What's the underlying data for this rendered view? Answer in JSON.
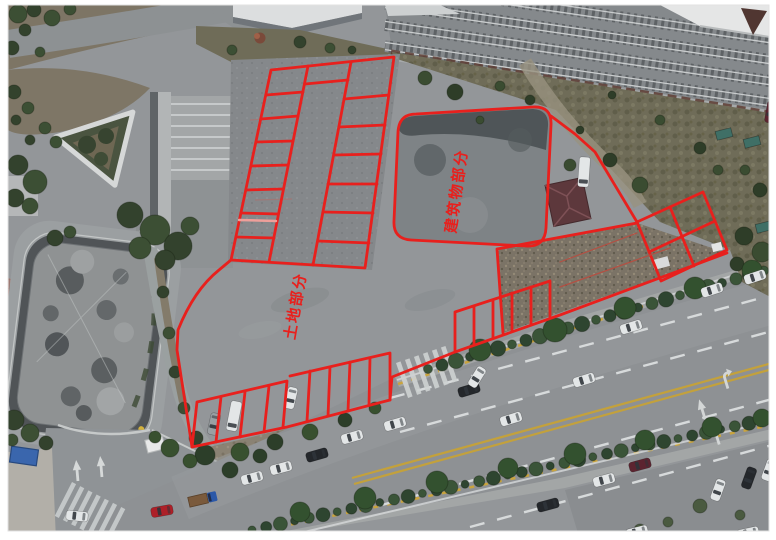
{
  "scene": {
    "background": "#ffffff",
    "asphalt": "#939699",
    "road": "#8e9194",
    "rail_ballast": "#85898c",
    "grass": "#6f6c58",
    "gravel": "#7b7366",
    "pond_rim": "#505457",
    "building_pad": "#7e8386",
    "marking_white": "#d7dadb",
    "marking_yellow": "#c3a13c",
    "hedge_green": "#2f4630",
    "shed_roof": "#5d383c"
  },
  "annotation": {
    "color": "#e8201d",
    "labels": [
      {
        "id": "building-area-label",
        "text": "建筑物部分",
        "x": 457,
        "y": 191,
        "rotate": -82,
        "size": 15
      },
      {
        "id": "land-area-label",
        "text": "土地部分",
        "x": 296,
        "y": 306,
        "rotate": -80,
        "size": 15
      }
    ],
    "paths": [
      {
        "id": "upper-grid-outline",
        "d": "M271,70 L394,57 L365,268 L231,260 Z"
      },
      {
        "id": "upper-grid-column-line-1",
        "d": "M308,66 L269,262"
      },
      {
        "id": "upper-grid-column-line-2",
        "d": "M351,62 L313,265"
      },
      {
        "id": "upper-grid-left-dividers",
        "d": "M266,95 L303,92 M261,119 L298,116 M256,142 L293,141 M251,166 L288,165 M246,190 L283,189 M241,213 L278,214 M236,237 L274,238"
      },
      {
        "id": "upper-grid-right-dividers",
        "d": "M344,99 L389,95 M339,127 L385,125 M334,155 L381,154 M328,184 L377,184 M323,212 L373,213 M318,241 L369,243"
      },
      {
        "id": "upper-grid-aisle-line",
        "d": "M305,84 L348,80"
      },
      {
        "id": "building-outline",
        "d": "M416,114 L533,107 Q552,106 551,125 L546,228 Q545,247 526,246 L411,240 Q393,239 394,221 L398,132 Q399,114 416,114 Z"
      },
      {
        "id": "northeast-boundary",
        "d": "M551,116 L575,134 L595,152 L637,222"
      },
      {
        "id": "east-grid-outline",
        "d": "M637,222 L703,192 L727,250 L661,281 Z"
      },
      {
        "id": "east-grid-inner-lines",
        "d": "M670,207 L694,266 M649,252 L715,221"
      },
      {
        "id": "gravel-area-edges",
        "d": "M497,249 L637,223 M497,249 L503,333"
      },
      {
        "id": "parcel-boundary",
        "d": "M231,260 L219,270 Q194,290 178,330 L177,350 L192,447 L287,427 L390,400 L392,377 L455,352 L560,315 L727,253"
      },
      {
        "id": "south-stalls-left",
        "d": "M197,402 L287,381 M197,402 L192,447 M221,397 L216,442 M245,392 L240,437 M269,386 L264,432 M287,381 L283,427"
      },
      {
        "id": "south-stalls-middle",
        "d": "M290,376 L390,353 L390,400 M310,371 L307,421 M330,367 L328,416 M350,362 L348,411 M370,358 L369,405"
      },
      {
        "id": "south-stalls-right",
        "d": "M455,312 L550,281 L550,318 M455,312 L455,352 M474,306 L474,345 M493,300 L493,338 M512,293 L512,331 M531,287 L531,325"
      },
      {
        "id": "faded-stall-line",
        "d": "M239,220 L276,221",
        "color": "#ef9f9a",
        "width": 2.5
      },
      {
        "id": "gravel-survey-lines",
        "d": "M560,262 L637,233 M560,287 L670,248",
        "color": "#b35043",
        "width": 1.2
      }
    ]
  },
  "vehicle_colors": {
    "white": "#e3e6e7",
    "dark": "#24272b",
    "red": "#ad2028",
    "maroon": "#5c2430",
    "silver": "#9aa0a3",
    "blue": "#2b58a8",
    "teal": "#3f6f66"
  },
  "vehicles": [
    {
      "x": 584,
      "y": 380,
      "r": -17,
      "t": "car",
      "c": "white"
    },
    {
      "x": 631,
      "y": 327,
      "r": -17,
      "t": "car",
      "c": "white"
    },
    {
      "x": 712,
      "y": 290,
      "r": -18,
      "t": "car",
      "c": "white"
    },
    {
      "x": 755,
      "y": 277,
      "r": -18,
      "t": "car",
      "c": "white"
    },
    {
      "x": 469,
      "y": 390,
      "r": -17,
      "t": "car",
      "c": "dark"
    },
    {
      "x": 511,
      "y": 419,
      "r": -17,
      "t": "car",
      "c": "white"
    },
    {
      "x": 162,
      "y": 511,
      "r": -10,
      "t": "car",
      "c": "red"
    },
    {
      "x": 203,
      "y": 499,
      "r": -13,
      "t": "truck",
      "c": "blue"
    },
    {
      "x": 252,
      "y": 478,
      "r": -15,
      "t": "car",
      "c": "white"
    },
    {
      "x": 281,
      "y": 468,
      "r": -15,
      "t": "car",
      "c": "white"
    },
    {
      "x": 317,
      "y": 455,
      "r": -16,
      "t": "car",
      "c": "dark"
    },
    {
      "x": 352,
      "y": 437,
      "r": -16,
      "t": "car",
      "c": "white"
    },
    {
      "x": 395,
      "y": 424,
      "r": -16,
      "t": "car",
      "c": "white"
    },
    {
      "x": 548,
      "y": 505,
      "r": -15,
      "t": "car",
      "c": "dark"
    },
    {
      "x": 604,
      "y": 480,
      "r": -15,
      "t": "car",
      "c": "white"
    },
    {
      "x": 640,
      "y": 465,
      "r": -15,
      "t": "car",
      "c": "maroon"
    },
    {
      "x": 718,
      "y": 490,
      "r": -70,
      "t": "car",
      "c": "white"
    },
    {
      "x": 749,
      "y": 478,
      "r": -70,
      "t": "car",
      "c": "dark"
    },
    {
      "x": 769,
      "y": 470,
      "r": -70,
      "t": "car",
      "c": "white"
    },
    {
      "x": 748,
      "y": 533,
      "r": -12,
      "t": "car",
      "c": "white"
    },
    {
      "x": 637,
      "y": 532,
      "r": -14,
      "t": "car",
      "c": "white"
    },
    {
      "x": 214,
      "y": 424,
      "r": -78,
      "t": "car",
      "c": "silver"
    },
    {
      "x": 234,
      "y": 416,
      "r": -79,
      "t": "van",
      "c": "white"
    },
    {
      "x": 291,
      "y": 398,
      "r": -77,
      "t": "car",
      "c": "white"
    },
    {
      "x": 477,
      "y": 377,
      "r": -58,
      "t": "car",
      "c": "white"
    },
    {
      "x": 77,
      "y": 516,
      "r": 6,
      "t": "car",
      "c": "white"
    },
    {
      "x": 584,
      "y": 172,
      "r": -86,
      "t": "van",
      "c": "white"
    },
    {
      "x": 771,
      "y": 112,
      "r": -80,
      "t": "car",
      "c": "maroon"
    },
    {
      "x": 724,
      "y": 134,
      "r": -14,
      "t": "box",
      "c": "teal"
    },
    {
      "x": 752,
      "y": 142,
      "r": -14,
      "t": "box",
      "c": "teal"
    },
    {
      "x": 764,
      "y": 227,
      "r": -14,
      "t": "box",
      "c": "teal"
    }
  ]
}
